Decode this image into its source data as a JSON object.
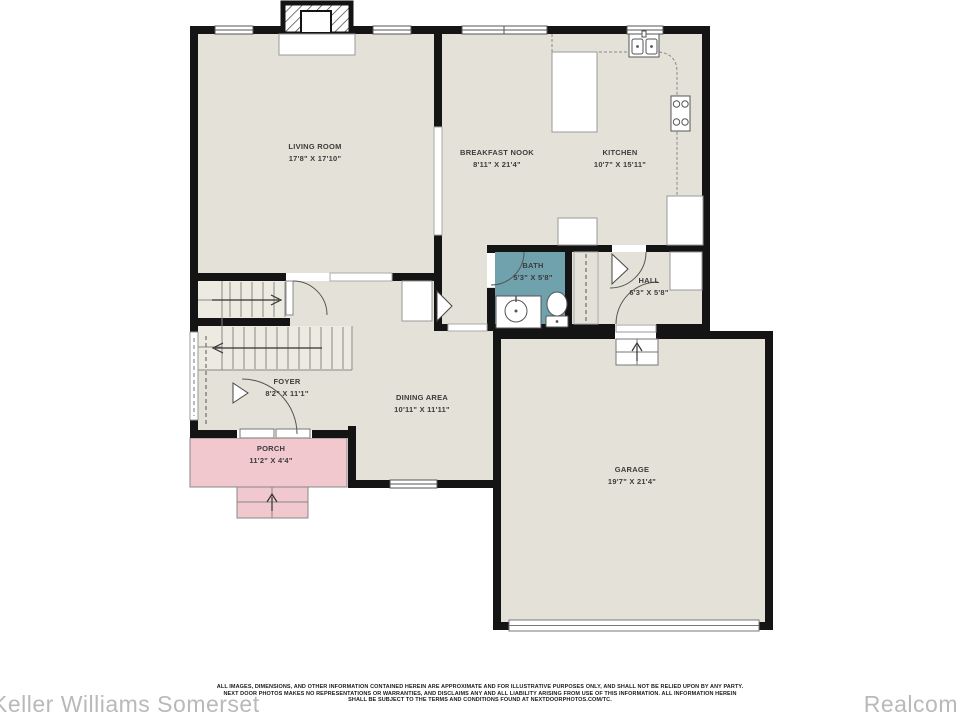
{
  "rooms": {
    "living": {
      "label": "LIVING ROOM",
      "dims": "17'8\" X 17'10\""
    },
    "breakfast": {
      "label": "BREAKFAST NOOK",
      "dims": "8'11\" X 21'4\""
    },
    "kitchen": {
      "label": "KITCHEN",
      "dims": "10'7\" X 15'11\""
    },
    "bath": {
      "label": "BATH",
      "dims": "5'3\" X 5'8\""
    },
    "hall": {
      "label": "HALL",
      "dims": "6'3\" X 5'8\""
    },
    "foyer": {
      "label": "FOYER",
      "dims": "8'2\" X 11'1\""
    },
    "dining": {
      "label": "DINING AREA",
      "dims": "10'11\" X 11'11\""
    },
    "porch": {
      "label": "PORCH",
      "dims": "11'2\" X 4'4\""
    },
    "garage": {
      "label": "GARAGE",
      "dims": "19'7\" X 21'4\""
    }
  },
  "watermarks": {
    "left": "Keller Williams Somerset",
    "right": "Realcom"
  },
  "disclaimer": {
    "line1": "ALL IMAGES, DIMENSIONS, AND OTHER INFORMATION CONTAINED HEREIN ARE APPROXIMATE AND FOR ILLUSTRATIVE PURPOSES ONLY, AND SHALL NOT BE RELIED UPON BY ANY PARTY.",
    "line2": "NEXT DOOR PHOTOS MAKES NO REPRESENTATIONS OR WARRANTIES, AND DISCLAIMS ANY AND ALL LIABILITY ARISING FROM USE OF THIS INFORMATION. ALL INFORMATION HEREIN",
    "line3": "SHALL BE SUBJECT TO THE TERMS AND CONDITIONS FOUND AT NEXTDOORPHOTOS.COM/TC."
  },
  "colors": {
    "wall": "#141414",
    "floor": "#e4e2d8",
    "stairs_floor": "#eceae1",
    "bath": "#6fa2ad",
    "porch": "#f1c8ce",
    "watermark": "#b9b9b9"
  }
}
